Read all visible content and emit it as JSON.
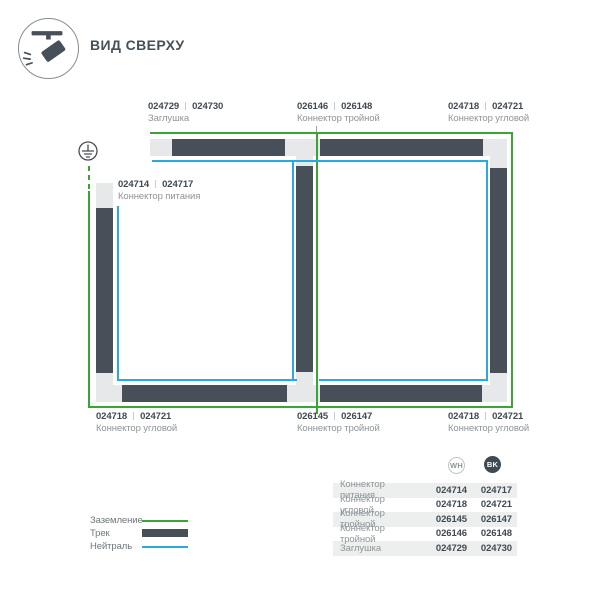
{
  "title": "ВИД СВЕРХУ",
  "icons": {
    "header_icon": "track-spotlight-icon",
    "ground_icon": "earth-ground-icon"
  },
  "colors": {
    "ground_green": "#3aa435",
    "neutral_blue": "#2aa9e0",
    "track_dark": "#475058",
    "connector_light": "#e7e8e9"
  },
  "parts": {
    "top_cap": {
      "wh": "024729",
      "bk": "024730",
      "name": "Заглушка"
    },
    "top_tee": {
      "wh": "026146",
      "bk": "026148",
      "name": "Коннектор тройной"
    },
    "top_corner": {
      "wh": "024718",
      "bk": "024721",
      "name": "Коннектор угловой"
    },
    "power": {
      "wh": "024714",
      "bk": "024717",
      "name": "Коннектор питания"
    },
    "bottom_corner_left": {
      "wh": "024718",
      "bk": "024721",
      "name": "Коннектор угловой"
    },
    "bottom_tee": {
      "wh": "026145",
      "bk": "026147",
      "name": "Коннектор тройной"
    },
    "bottom_corner_right": {
      "wh": "024718",
      "bk": "024721",
      "name": "Коннектор угловой"
    }
  },
  "legend": {
    "ground": "Заземление",
    "track": "Трек",
    "neutral": "Нейтраль"
  },
  "table": {
    "columns": {
      "wh": "WH",
      "bk": "BK"
    },
    "rows": [
      {
        "name": "Коннектор питания",
        "wh": "024714",
        "bk": "024717"
      },
      {
        "name": "Коннектор угловой",
        "wh": "024718",
        "bk": "024721"
      },
      {
        "name": "Коннектор тройной",
        "wh": "026145",
        "bk": "026147"
      },
      {
        "name": "Коннектор тройной",
        "wh": "026146",
        "bk": "026148"
      },
      {
        "name": "Заглушка",
        "wh": "024729",
        "bk": "024730"
      }
    ]
  }
}
